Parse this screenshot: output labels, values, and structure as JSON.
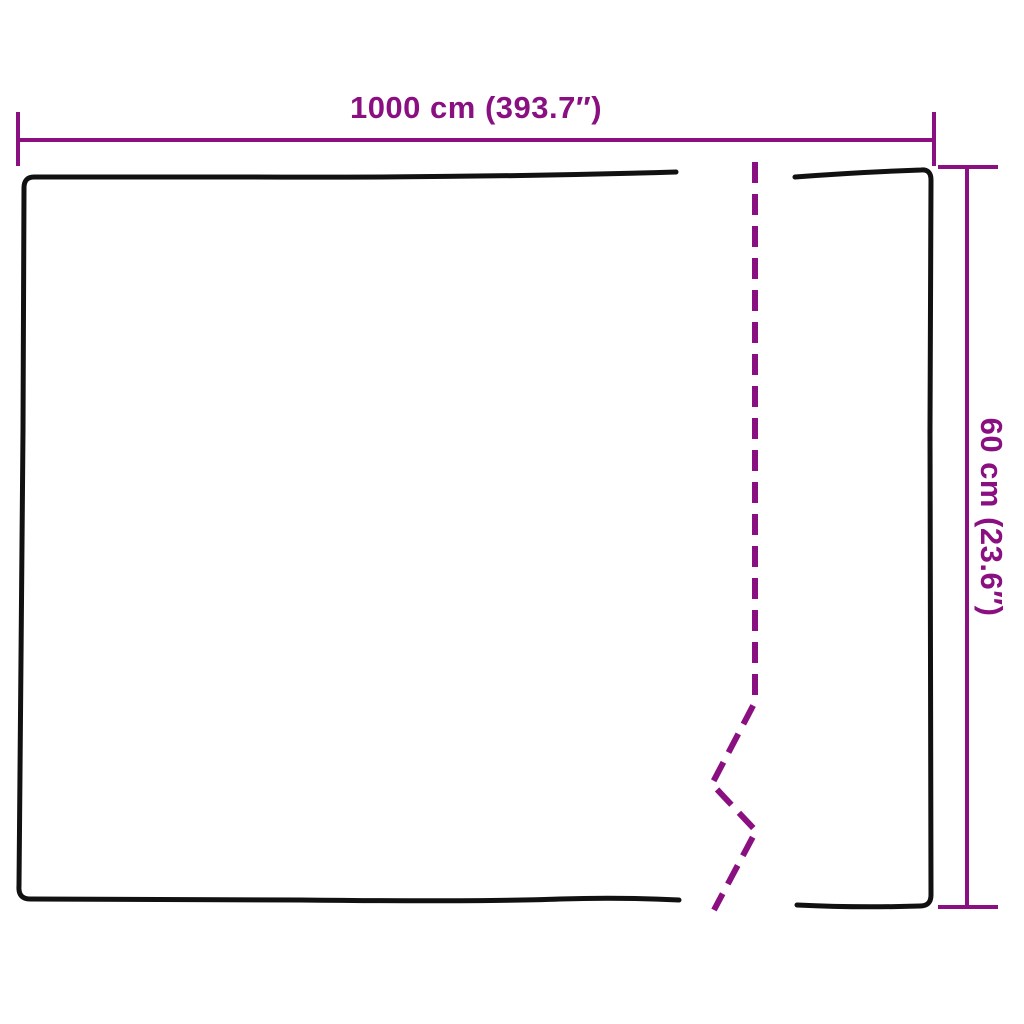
{
  "diagram": {
    "type": "product-dimension-diagram",
    "width_dimension": {
      "label": "1000 cm (393.7″)",
      "value_cm": 1000,
      "value_inches": 393.7
    },
    "height_dimension": {
      "label": "60 cm (23.6″)",
      "value_cm": 60,
      "value_inches": 23.6
    }
  },
  "colors": {
    "accent": "#8A1082",
    "outline": "#111111",
    "background": "#FFFFFF"
  }
}
